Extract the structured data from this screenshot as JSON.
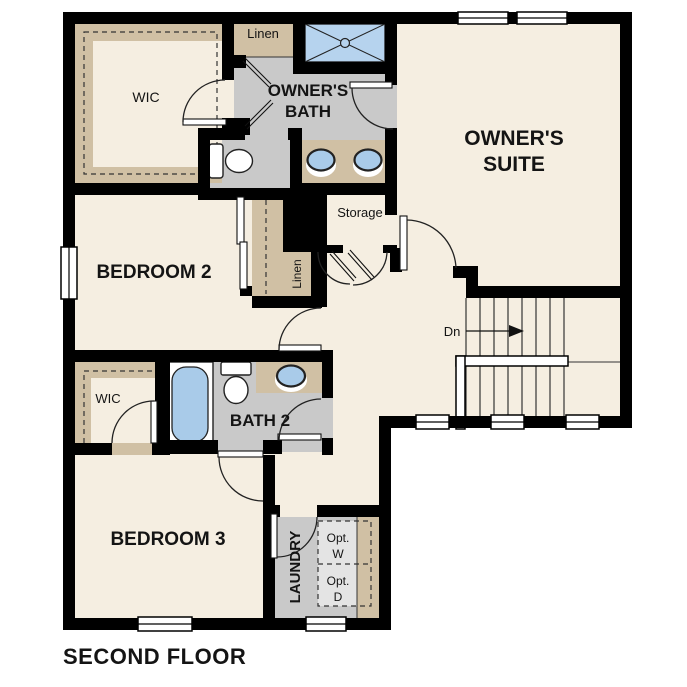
{
  "title": "SECOND FLOOR",
  "colors": {
    "floor_cream": "#f5eee1",
    "wet_gray": "#c9c9c9",
    "cabinet_tan": "#d0c0a4",
    "fixture_blue": "#a9cbe9",
    "shower_blue": "#b6d3ee",
    "optional_gray": "#e4e4e4",
    "wall_black": "#000000",
    "white": "#ffffff"
  },
  "rooms": {
    "owners_suite": {
      "line1": "OWNER'S",
      "line2": "SUITE"
    },
    "owners_bath": {
      "line1": "OWNER'S",
      "line2": "BATH"
    },
    "bedroom2": {
      "label": "BEDROOM 2"
    },
    "bedroom3": {
      "label": "BEDROOM 3"
    },
    "bath2": {
      "label": "BATH 2"
    },
    "wic_upper": {
      "label": "WIC"
    },
    "wic_lower": {
      "label": "WIC"
    },
    "linen_upper": {
      "label": "Linen"
    },
    "linen_hall": {
      "label": "Linen"
    },
    "storage": {
      "label": "Storage"
    },
    "laundry": {
      "label": "LAUNDRY"
    },
    "optional_washer": {
      "line1": "Opt.",
      "line2": "W"
    },
    "optional_dryer": {
      "line1": "Opt.",
      "line2": "D"
    },
    "stairs": {
      "direction_label": "Dn"
    }
  }
}
